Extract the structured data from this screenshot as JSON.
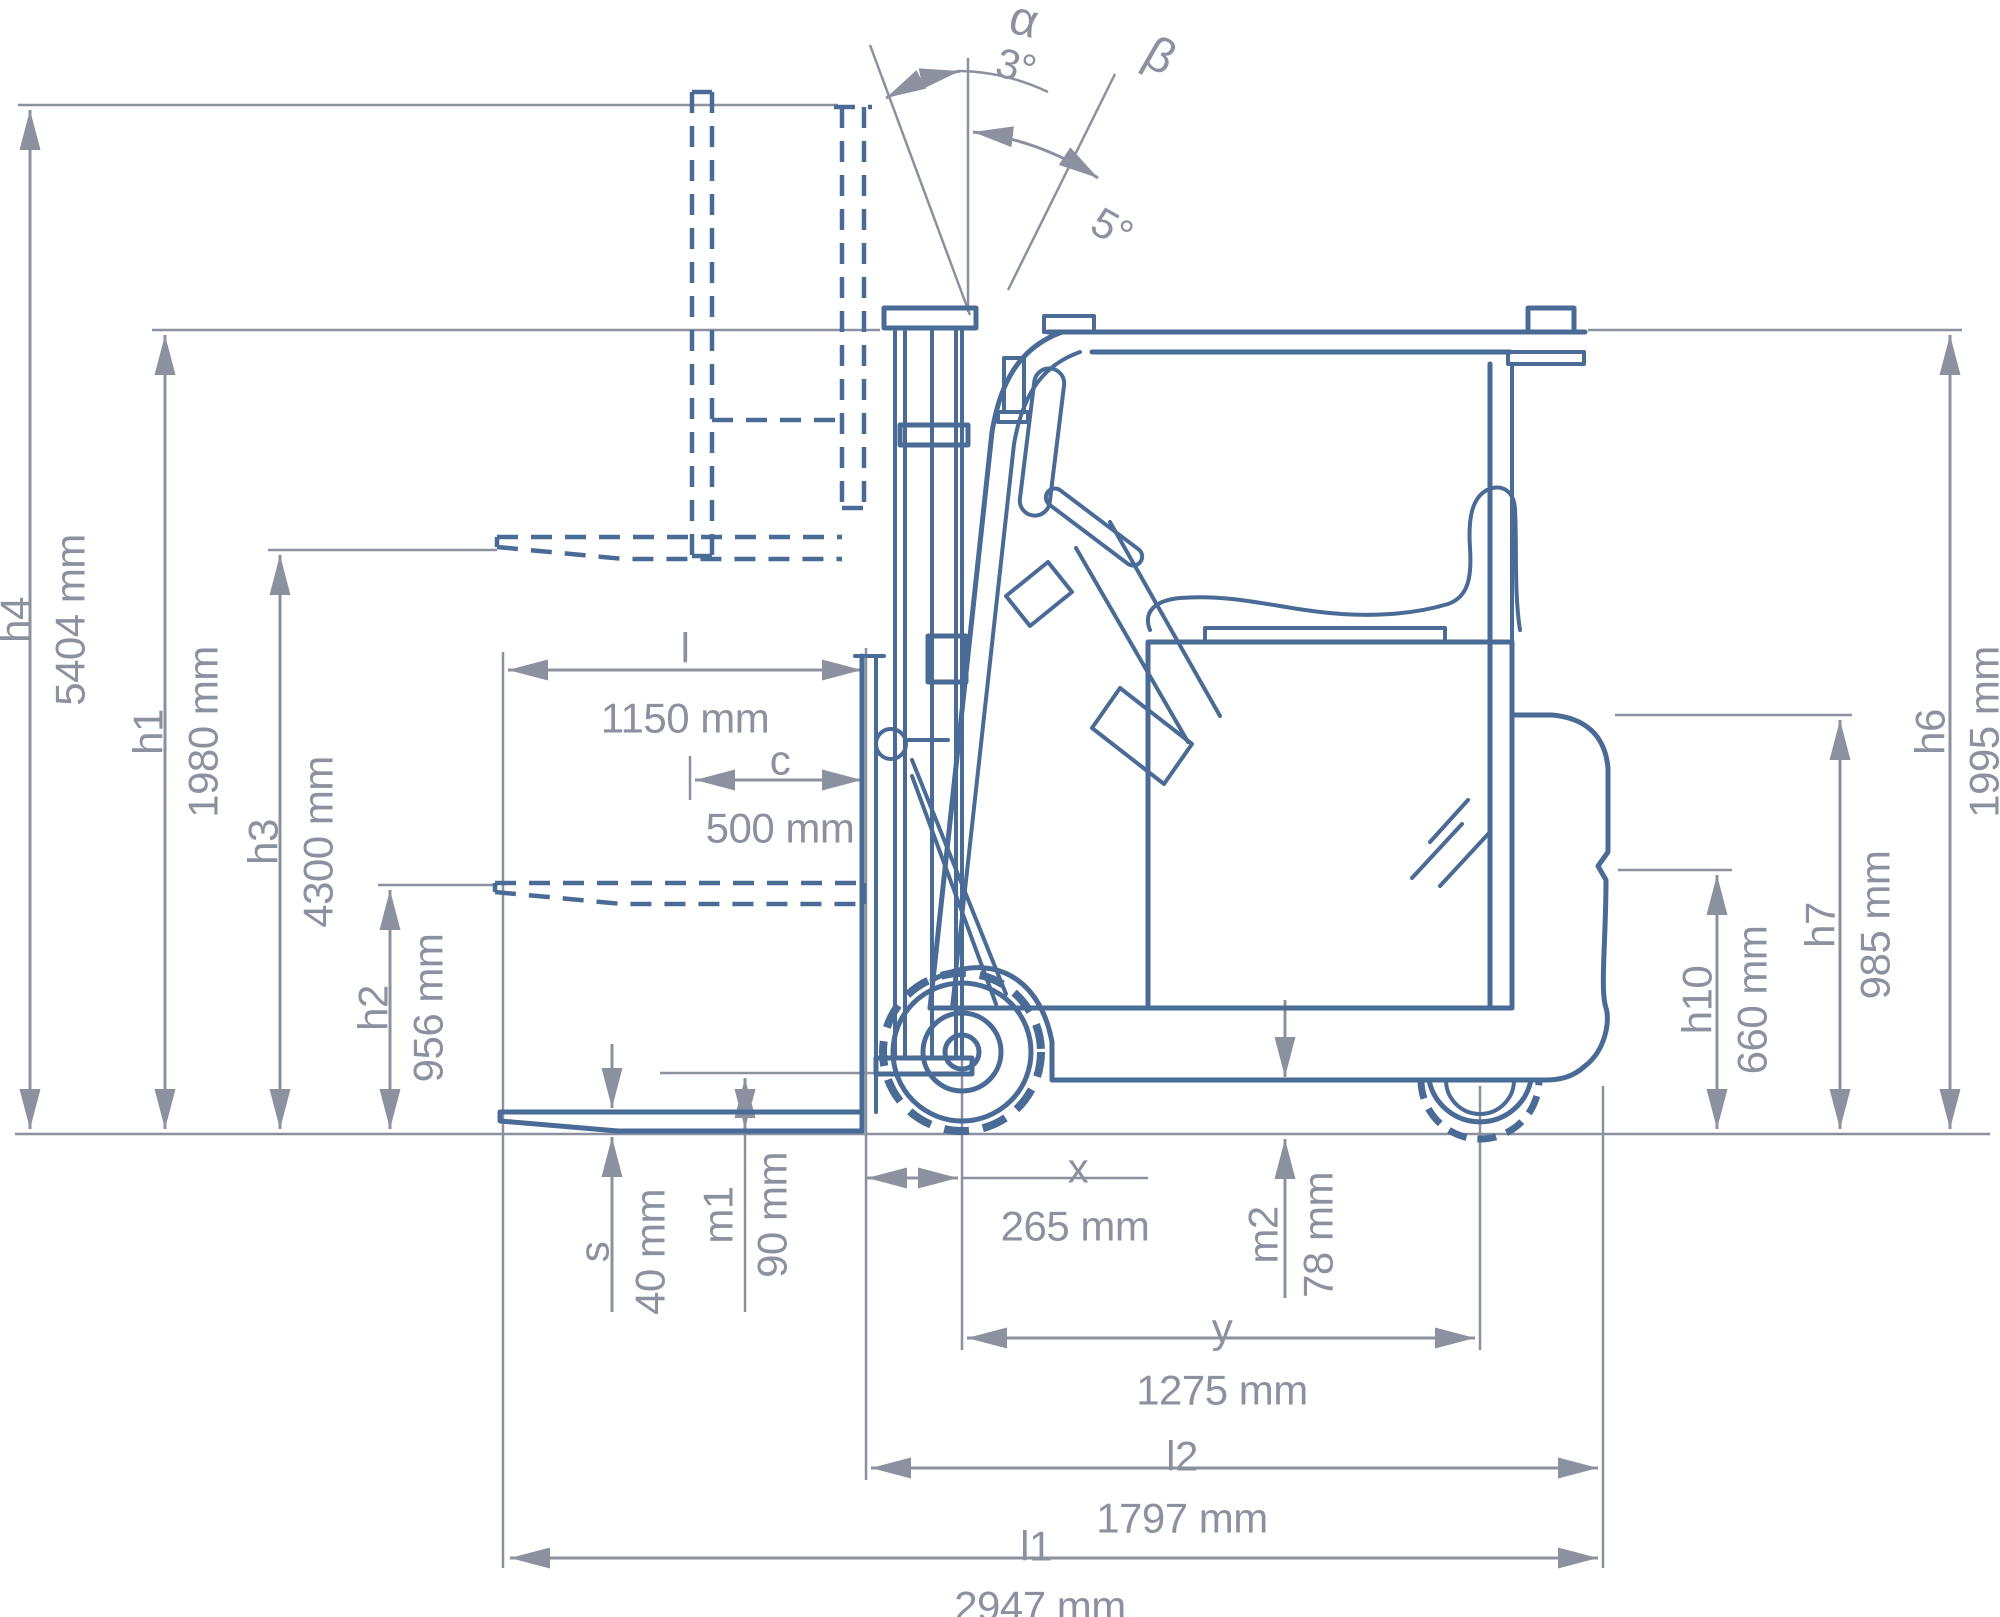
{
  "diagram": {
    "type": "technical-dimension-drawing",
    "subject": "forklift-side-view",
    "colors": {
      "drawing": "#4a6b96",
      "dimension": "#8c91a0",
      "background": "#ffffff"
    },
    "angles": {
      "alpha": {
        "label": "α",
        "value": "3°"
      },
      "beta": {
        "label": "β",
        "value": "5°"
      }
    },
    "dimensions": {
      "h4": {
        "label": "h4",
        "value": "5404 mm"
      },
      "h1": {
        "label": "h1",
        "value": "1980 mm"
      },
      "h3": {
        "label": "h3",
        "value": "4300 mm"
      },
      "h2": {
        "label": "h2",
        "value": "956 mm"
      },
      "l": {
        "label": "l",
        "value": "1150 mm"
      },
      "c": {
        "label": "c",
        "value": "500 mm"
      },
      "s": {
        "label": "s",
        "value": "40 mm"
      },
      "m1": {
        "label": "m1",
        "value": "90 mm"
      },
      "x": {
        "label": "x",
        "value": "265 mm"
      },
      "m2": {
        "label": "m2",
        "value": "78 mm"
      },
      "y": {
        "label": "y",
        "value": "1275 mm"
      },
      "l2": {
        "label": "l2",
        "value": "1797 mm"
      },
      "l1": {
        "label": "l1",
        "value": "2947 mm"
      },
      "h6": {
        "label": "h6",
        "value": "1995 mm"
      },
      "h7": {
        "label": "h7",
        "value": "985 mm"
      },
      "h10": {
        "label": "h10",
        "value": "660 mm"
      }
    }
  }
}
